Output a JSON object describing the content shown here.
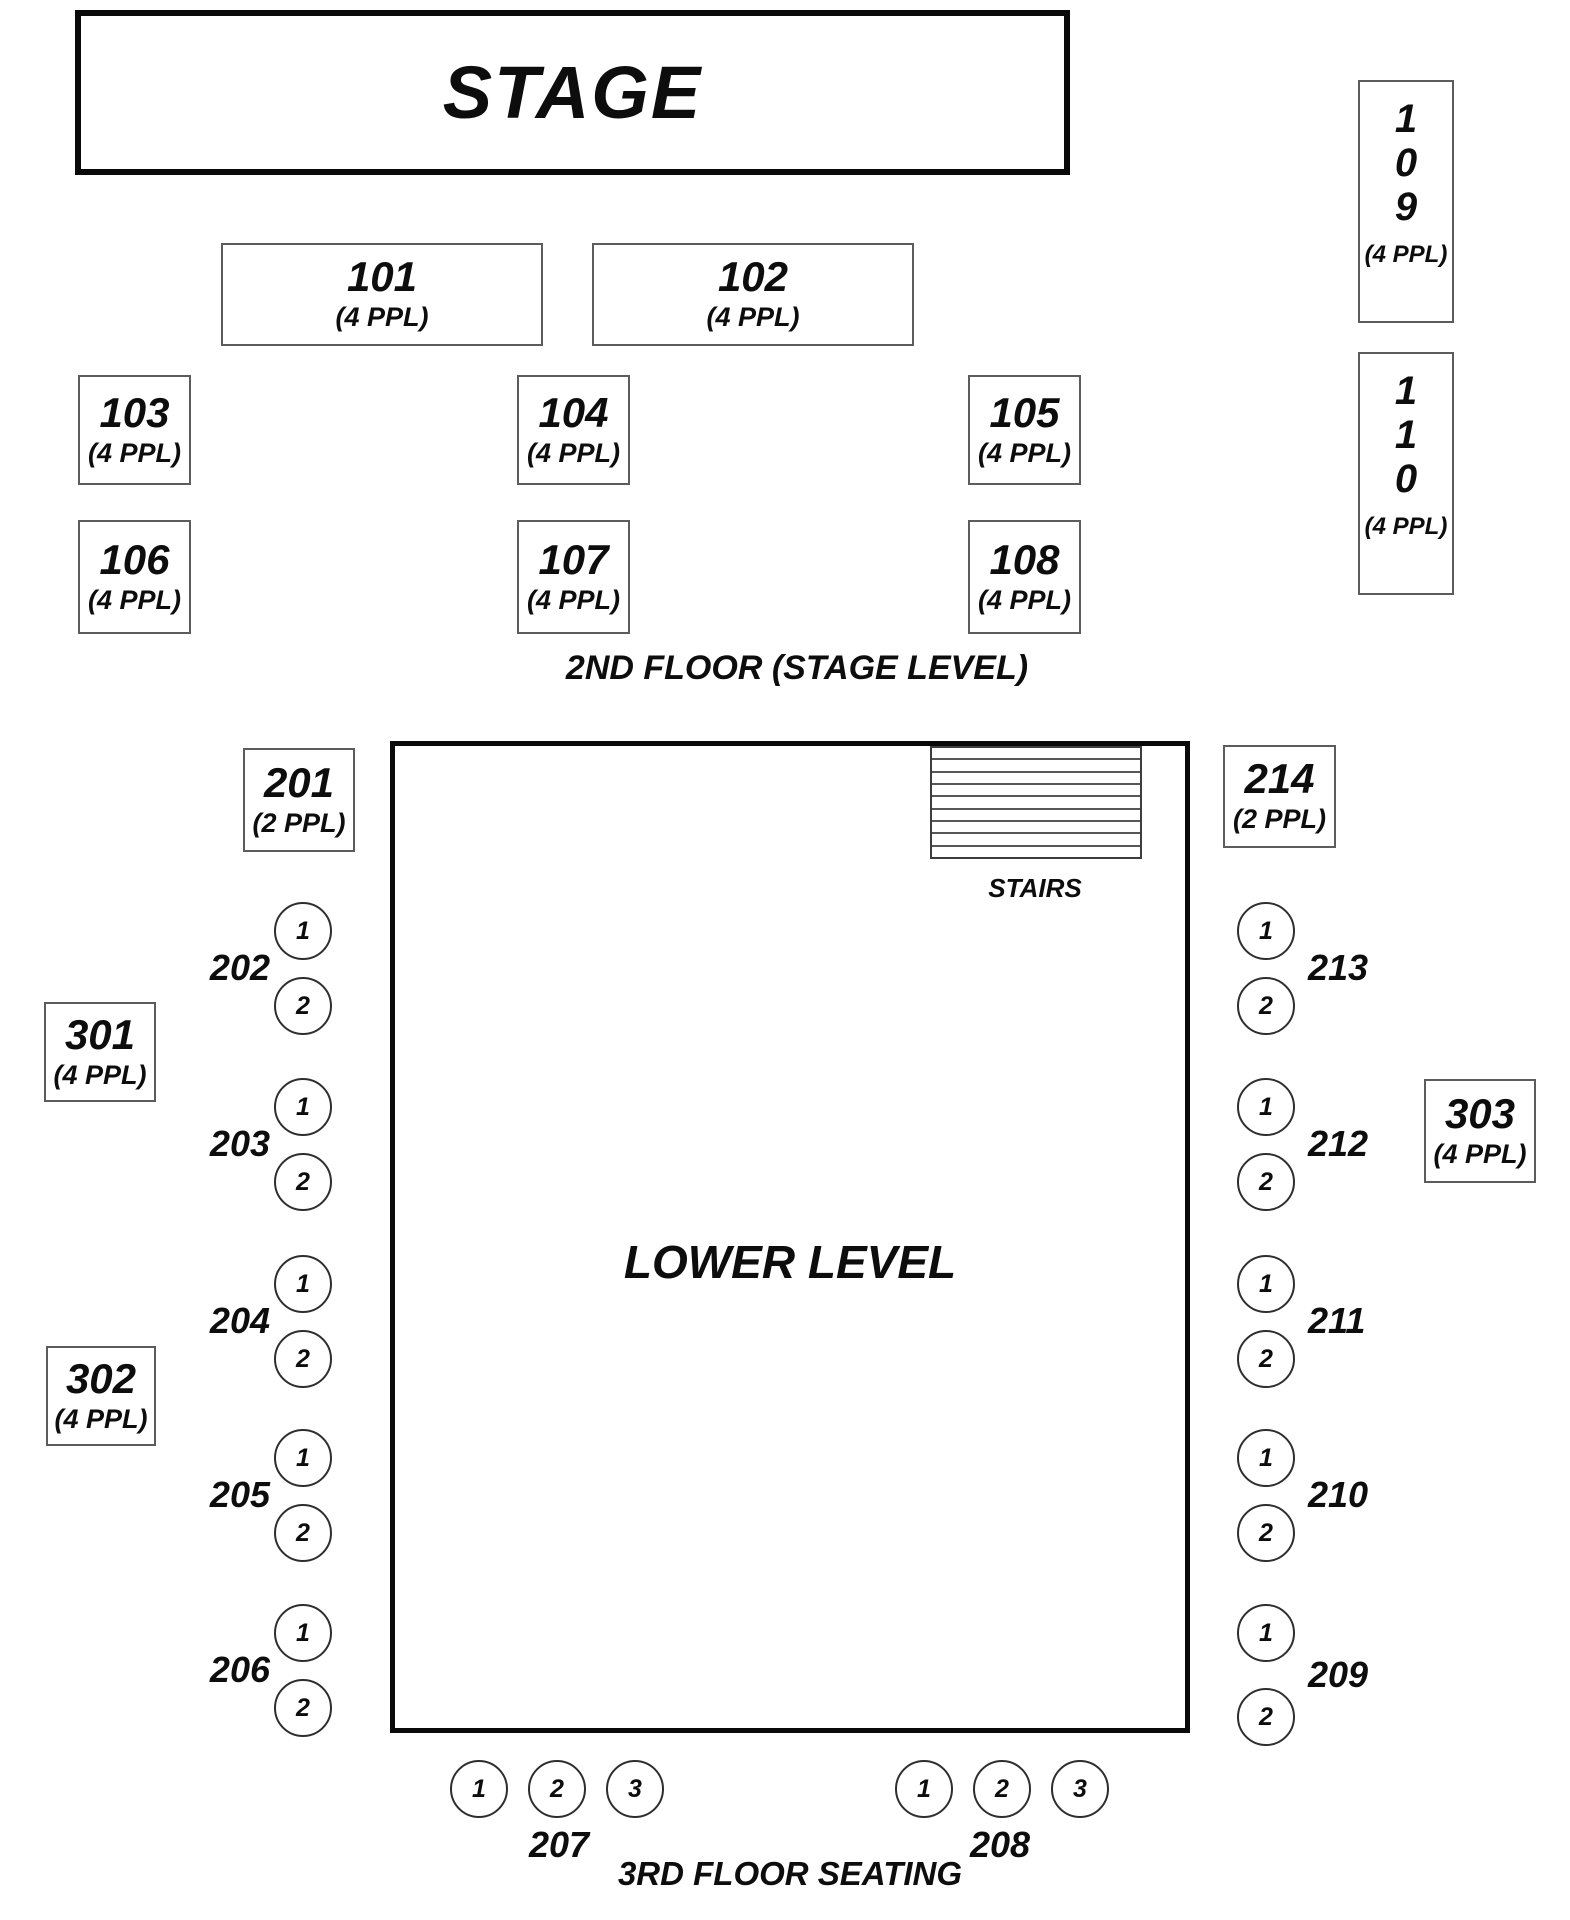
{
  "stage": {
    "label": "STAGE"
  },
  "floor2": {
    "caption": "2ND FLOOR (STAGE LEVEL)",
    "tables": {
      "101": {
        "num": "101",
        "cap": "(4 PPL)"
      },
      "102": {
        "num": "102",
        "cap": "(4 PPL)"
      },
      "103": {
        "num": "103",
        "cap": "(4 PPL)"
      },
      "104": {
        "num": "104",
        "cap": "(4 PPL)"
      },
      "105": {
        "num": "105",
        "cap": "(4 PPL)"
      },
      "106": {
        "num": "106",
        "cap": "(4 PPL)"
      },
      "107": {
        "num": "107",
        "cap": "(4 PPL)"
      },
      "108": {
        "num": "108",
        "cap": "(4 PPL)"
      },
      "109": {
        "d1": "1",
        "d2": "0",
        "d3": "9",
        "cap": "(4 PPL)"
      },
      "110": {
        "d1": "1",
        "d2": "1",
        "d3": "0",
        "cap": "(4 PPL)"
      }
    }
  },
  "lower": {
    "label": "LOWER LEVEL",
    "stairs_label": "STAIRS"
  },
  "floor3": {
    "caption": "3RD FLOOR SEATING",
    "tables": {
      "201": {
        "num": "201",
        "cap": "(2 PPL)"
      },
      "214": {
        "num": "214",
        "cap": "(2 PPL)"
      },
      "301": {
        "num": "301",
        "cap": "(4 PPL)"
      },
      "302": {
        "num": "302",
        "cap": "(4 PPL)"
      },
      "303": {
        "num": "303",
        "cap": "(4 PPL)"
      }
    },
    "left_rows": [
      {
        "label": "202",
        "s1": "1",
        "s2": "2"
      },
      {
        "label": "203",
        "s1": "1",
        "s2": "2"
      },
      {
        "label": "204",
        "s1": "1",
        "s2": "2"
      },
      {
        "label": "205",
        "s1": "1",
        "s2": "2"
      },
      {
        "label": "206",
        "s1": "1",
        "s2": "2"
      }
    ],
    "right_rows": [
      {
        "label": "213",
        "s1": "1",
        "s2": "2"
      },
      {
        "label": "212",
        "s1": "1",
        "s2": "2"
      },
      {
        "label": "211",
        "s1": "1",
        "s2": "2"
      },
      {
        "label": "210",
        "s1": "1",
        "s2": "2"
      },
      {
        "label": "209",
        "s1": "1",
        "s2": "2"
      }
    ],
    "bottom_rows": [
      {
        "label": "207",
        "s1": "1",
        "s2": "2",
        "s3": "3"
      },
      {
        "label": "208",
        "s1": "1",
        "s2": "2",
        "s3": "3"
      }
    ]
  }
}
